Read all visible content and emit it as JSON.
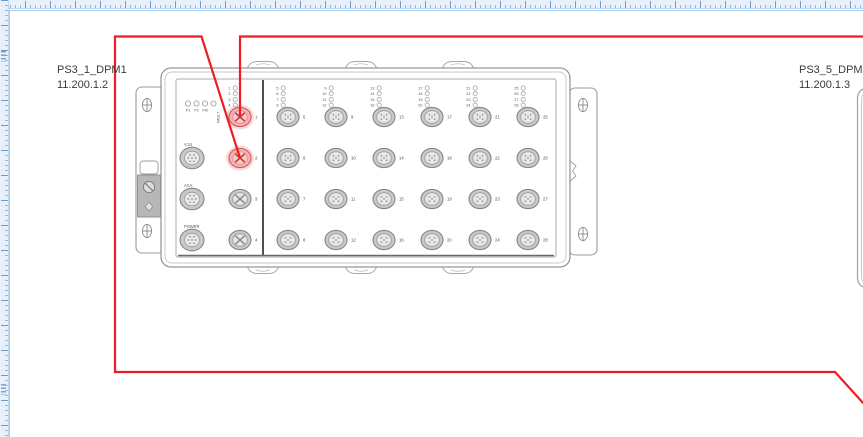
{
  "diagram": {
    "devices": [
      {
        "label": "PS3_1_DPM1",
        "address": "11.200.1.2"
      },
      {
        "label": "PS3_5_DPM1",
        "address": "11.200.1.3"
      }
    ]
  },
  "device_front": {
    "status_leds": [
      "P1",
      "P2",
      "FM",
      "FAULT"
    ],
    "service_connectors": [
      "V.24",
      "ACA",
      "POWER"
    ],
    "port_columns": [
      [
        1,
        2,
        3,
        4
      ],
      [
        5,
        6,
        7,
        8
      ],
      [
        9,
        10,
        11,
        12
      ],
      [
        13,
        14,
        15,
        16
      ],
      [
        17,
        18,
        19,
        20
      ],
      [
        21,
        22,
        23,
        24
      ],
      [
        25,
        26,
        27,
        28
      ]
    ],
    "highlighted_ports": [
      1,
      2
    ]
  },
  "connections": [
    {
      "name": "cable-port-1",
      "points": [
        [
          240,
          117
        ],
        [
          240,
          36.5
        ],
        [
          863,
          36.5
        ]
      ]
    },
    {
      "name": "cable-port-2",
      "points": [
        [
          240,
          158
        ],
        [
          201.5,
          36.5
        ],
        [
          115,
          36.5
        ],
        [
          115,
          372
        ],
        [
          835,
          372
        ],
        [
          864,
          404
        ]
      ]
    }
  ],
  "colors": {
    "cable_red": "#ef1c23",
    "highlight_halo": "rgba(242,130,130,0.30)",
    "highlight_fill": "#f2b2b2",
    "highlight_stroke": "#d45c5c",
    "highlight_inner_fill": "#f8caca",
    "highlight_inner_stroke": "#e09090",
    "highlight_cross": "#c63333",
    "port_ring_fill": "#c9c9c9",
    "port_ring_stroke": "#878787",
    "port_inner_fill": "#e8e8e8",
    "port_inner_stroke": "#9a9a9a",
    "tiny_text": "#4a4a4a"
  }
}
